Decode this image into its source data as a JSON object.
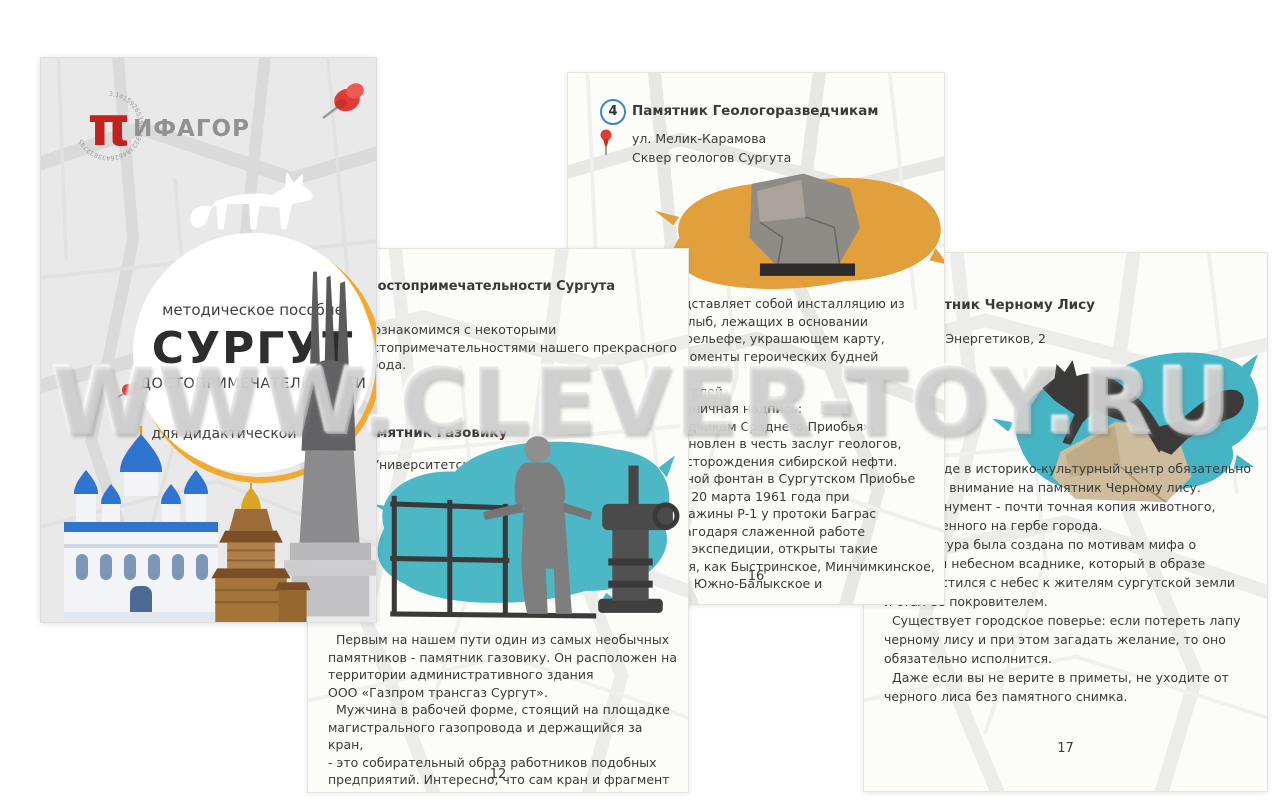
{
  "watermark": "WWW.CLEVER-TOY.RU",
  "colors": {
    "accent_teal": "#4cb7c5",
    "accent_yellow": "#e1a03c",
    "ring_yellow": "#f3a92e",
    "logo_red": "#c4201f",
    "pin_red": "#e23b34",
    "badge_blue": "#3a87c8",
    "cover_grey": "#e9e9e9"
  },
  "icons": {
    "pushpin": "red pushpin",
    "location_pin": "red map pin",
    "fox_silhouette": "white fox silhouette",
    "pi_logo": "red greek pi"
  },
  "cover": {
    "logo": {
      "pi": "π",
      "name": "ИФАГОР",
      "ring_digits": "3,1415926535897932384626433832795"
    },
    "circle": {
      "kicker": "методическое пособие",
      "title": "СУРГУТ",
      "subtitle": "ДОСТОПРИМЕЧАТЕЛЬНОСТИ",
      "note": "для дидактической панели"
    }
  },
  "page12": {
    "section_header": "Достопримечательности Сургута",
    "intro": "  Познакомимся с некоторыми\nдостопримечательностями нашего прекрасного\nгорода.",
    "badge": "1",
    "title": "Памятник Газовику",
    "address": "ул. Университетская",
    "body": "  Первым на нашем пути один из самых необычных\nпамятников - памятник газовику. Он расположен на\nтерритории административного здания\nООО «Газпром трансгаз Сургут».\n  Мужчина в рабочей форме, стоящий на площадке\nмагистрального газопровода и держащийся за кран,\n- это собирательный образ работников подобных\nпредприятий. Интересно, что сам кран и фрагмент",
    "page_number": "12"
  },
  "page16": {
    "badge": "4",
    "title": "Памятник Геологоразведчикам",
    "address1": "ул. Мелик-Карамова",
    "address2": "Сквер геологов Сургута",
    "body": "Памятник представляет собой инсталляцию из\nобветренных глыб, лежащих в основании\nстелы, и на барельефе, украшающем карту,\nзапечатлены моменты героических будней геологов-\nпервооткрывателей.\nНа стеле - лаконичная надпись:\n«Геологоразведчикам Среднего Приобья».\nПамятник установлен в честь заслуг геологов,\nоткрывших месторождения сибирской нефти.\nПервый нефтяной фонтан в Сургутском Приобье\nзабил вечером 20 марта 1961 года при\nиспытании скважины Р-1 у протоки Баграс\n(река Обь). Благодаря слаженной работе\nгеологической экспедиции, открыты такие\nместорождения, как Быстринское, Минчимкинское,\nМамонтовское, Южно-Балыкское и",
    "page_number": "16"
  },
  "page17": {
    "badge": "5",
    "title": "Памятник Черному Лису",
    "address": "ул. Энергетиков, 2",
    "body": "  При входе в историко-культурный центр обязательно\nобратите внимание на памятник Черному лису.\n  Этот монумент - почти точная копия животного,\nизображенного на гербе города.\n  Скульптура была создана по мотивам мифа о\nчудесном небесном всаднике, который в образе\nлиса спустился с небес к жителям сургутской земли\nи стал её покровителем.\n  Существует городское поверье: если потереть лапу\nчерному лису и при этом загадать желание, то оно\nобязательно исполнится.\n  Даже если вы не верите в приметы, не уходите от\nчерного лиса без памятного снимка.",
    "page_number": "17"
  }
}
